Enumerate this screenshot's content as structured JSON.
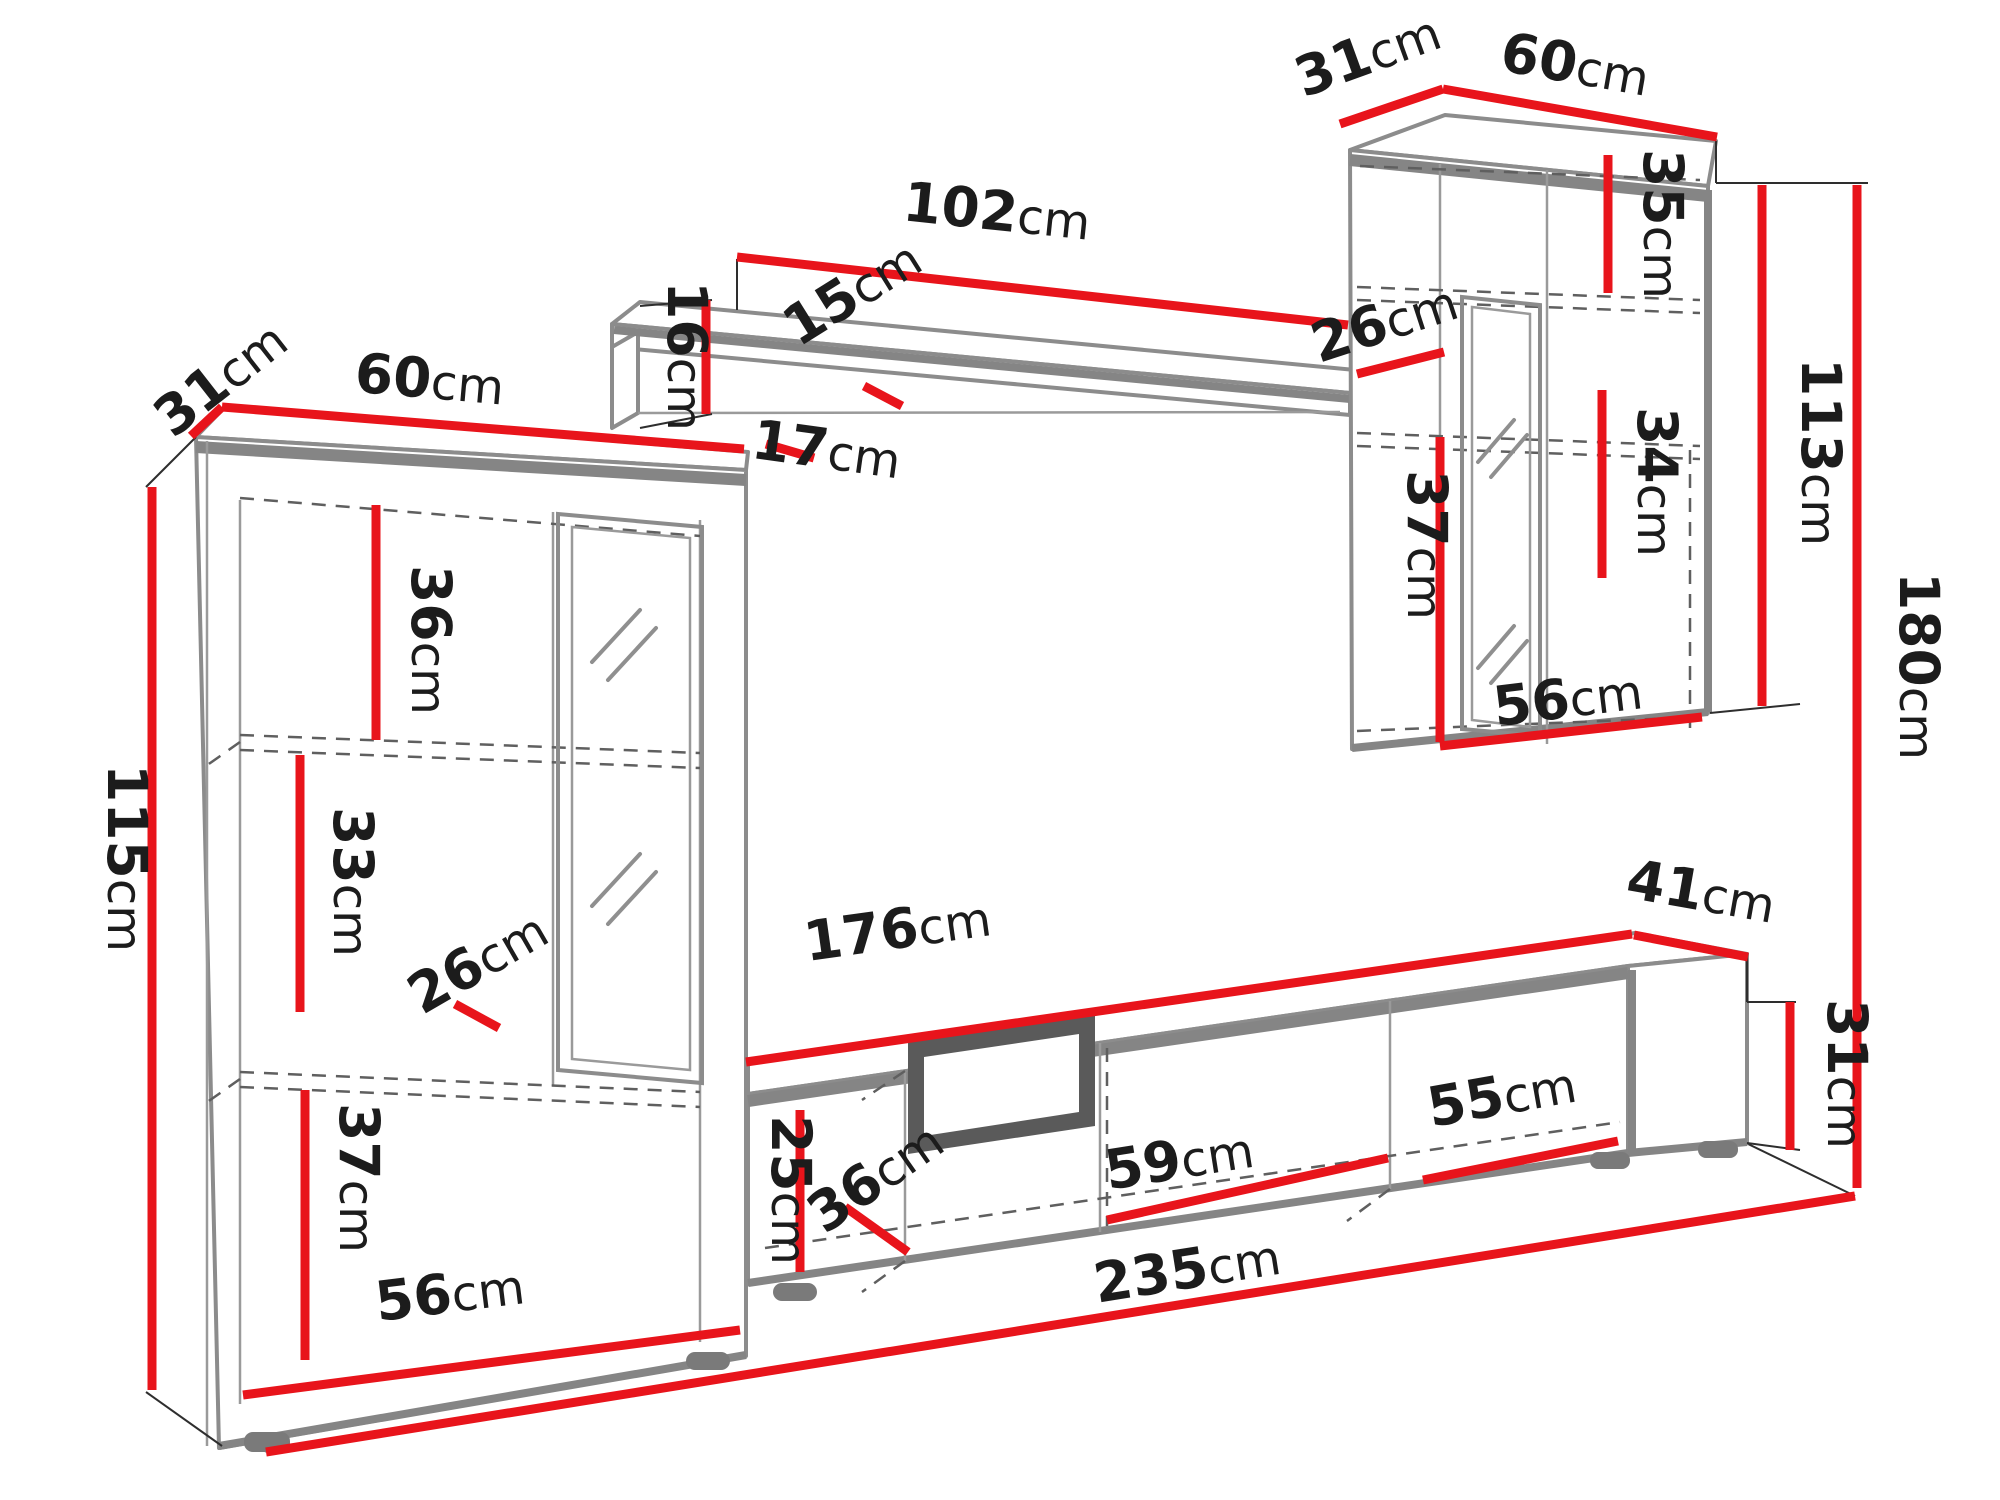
{
  "diagram": {
    "type": "furniture-dimension-drawing",
    "subject": "living room wall unit with two cabinets, wall shelf and TV stand",
    "unit": "cm",
    "colors": {
      "dimension_line": "#e8141b",
      "outline": "#8c8c8c",
      "hidden_line": "#5f5f5f",
      "label_text": "#1c1c1c",
      "background": "#ffffff"
    }
  },
  "dims": {
    "left_cabinet": {
      "depth": {
        "value": "31",
        "unit": "cm"
      },
      "width": {
        "value": "60",
        "unit": "cm"
      },
      "height": {
        "value": "115",
        "unit": "cm"
      },
      "top_section": {
        "value": "36",
        "unit": "cm"
      },
      "middle_section": {
        "value": "33",
        "unit": "cm"
      },
      "shelf_depth": {
        "value": "26",
        "unit": "cm"
      },
      "bottom_section": {
        "value": "37",
        "unit": "cm"
      },
      "interior_width": {
        "value": "56",
        "unit": "cm"
      }
    },
    "wall_shelf": {
      "length": {
        "value": "102",
        "unit": "cm"
      },
      "height": {
        "value": "16",
        "unit": "cm"
      },
      "depth": {
        "value": "15",
        "unit": "cm"
      },
      "cabinet_gap": {
        "value": "17",
        "unit": "cm"
      }
    },
    "right_cabinet": {
      "depth": {
        "value": "31",
        "unit": "cm"
      },
      "width": {
        "value": "60",
        "unit": "cm"
      },
      "top_section": {
        "value": "35",
        "unit": "cm"
      },
      "shelf_depth": {
        "value": "26",
        "unit": "cm"
      },
      "middle_section": {
        "value": "34",
        "unit": "cm"
      },
      "height": {
        "value": "113",
        "unit": "cm"
      },
      "bottom_section": {
        "value": "37",
        "unit": "cm"
      },
      "interior_width": {
        "value": "56",
        "unit": "cm"
      }
    },
    "tv_stand": {
      "length": {
        "value": "176",
        "unit": "cm"
      },
      "depth": {
        "value": "41",
        "unit": "cm"
      },
      "height": {
        "value": "31",
        "unit": "cm"
      },
      "interior_height": {
        "value": "25",
        "unit": "cm"
      },
      "interior_depth": {
        "value": "36",
        "unit": "cm"
      },
      "middle_width": {
        "value": "59",
        "unit": "cm"
      },
      "right_width": {
        "value": "55",
        "unit": "cm"
      }
    },
    "overall": {
      "height": {
        "value": "180",
        "unit": "cm"
      },
      "width": {
        "value": "235",
        "unit": "cm"
      }
    }
  }
}
